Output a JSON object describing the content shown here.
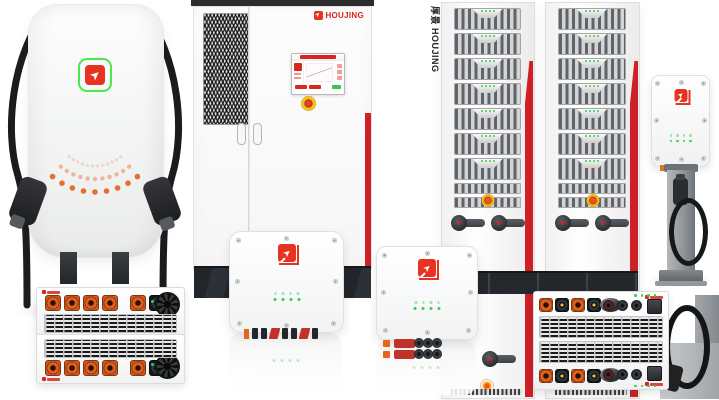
{
  "brand": {
    "name": "HOUJING",
    "vertical_label": "厚景 HOUJING",
    "logo_glyph": "➤"
  },
  "colors": {
    "brand_red": "#d7261d",
    "logo_red": "#e63322",
    "logo_green": "#4ce84a",
    "stripe_red": "#ce2026",
    "orange_connector": "#e5641f",
    "led_green": "#41c752",
    "indicator_orange": "#ff9b1e",
    "estop_yellow": "#f2c11e",
    "estop_red": "#d63a24",
    "dark_base": "#24282d",
    "cable_black": "#1b1c1e",
    "pedestal_gray": "#9aa0a5",
    "body_white": "#f8f9f9"
  },
  "pillar": {
    "dot_arcs": [
      {
        "count": 12,
        "radius": 40,
        "opacity": 0.18,
        "size": 1.7
      },
      {
        "count": 11,
        "radius": 53,
        "opacity": 0.42,
        "size": 2.2
      },
      {
        "count": 9,
        "radius": 66,
        "opacity": 0.92,
        "size": 2.8
      }
    ]
  },
  "racks": {
    "notch_modules": 7,
    "plain_rows": 2,
    "leds_per_module": 4
  },
  "leds": {
    "wallbox_per_row": 4,
    "pedestal_per_row": 4,
    "module_count": 4,
    "wide_count": 4
  },
  "connectors": {
    "wallbox_a_bottom": [
      "o2",
      "k2",
      "k2",
      "r2",
      "k2",
      "k2",
      "r2",
      "k2"
    ],
    "wallbox_b_side": [
      "o3",
      "rpill",
      "c3",
      "c3",
      "c3"
    ],
    "module_row": [
      "osq",
      "osq",
      "osq",
      "osq",
      "sp",
      "osq",
      "ksq"
    ],
    "wide_row": [
      "osq",
      "ksq",
      "osq",
      "ksq"
    ]
  }
}
